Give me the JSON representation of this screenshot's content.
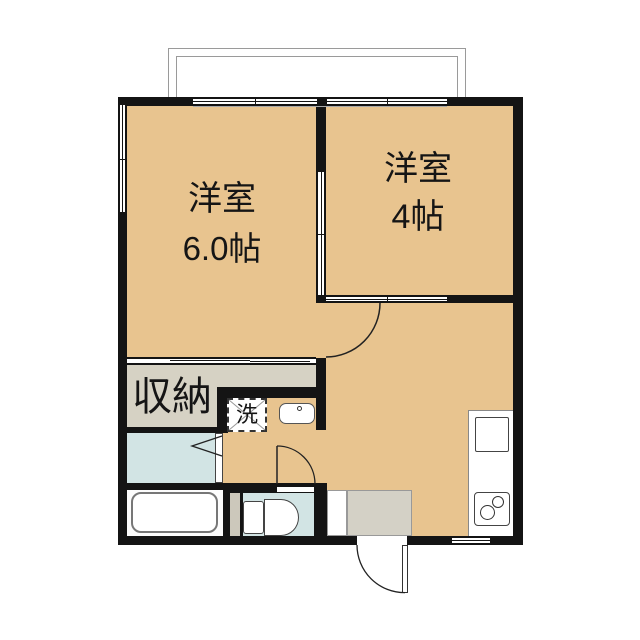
{
  "rooms": {
    "western1": {
      "name": "洋室",
      "size": "6.0帖"
    },
    "western2": {
      "name": "洋室",
      "size": "4帖"
    },
    "closet": {
      "label": "収納"
    },
    "laundry": {
      "label": "洗"
    }
  },
  "colors": {
    "wall": "#141414",
    "room_fill": "#e8c48f",
    "wet_area_fill": "#d2e4e4",
    "closet_fill": "#d6d2c4",
    "entry_fill": "#d4d1c6",
    "strip_fill": "#ccc8bb",
    "balcony_line": "#9a9a9a"
  }
}
